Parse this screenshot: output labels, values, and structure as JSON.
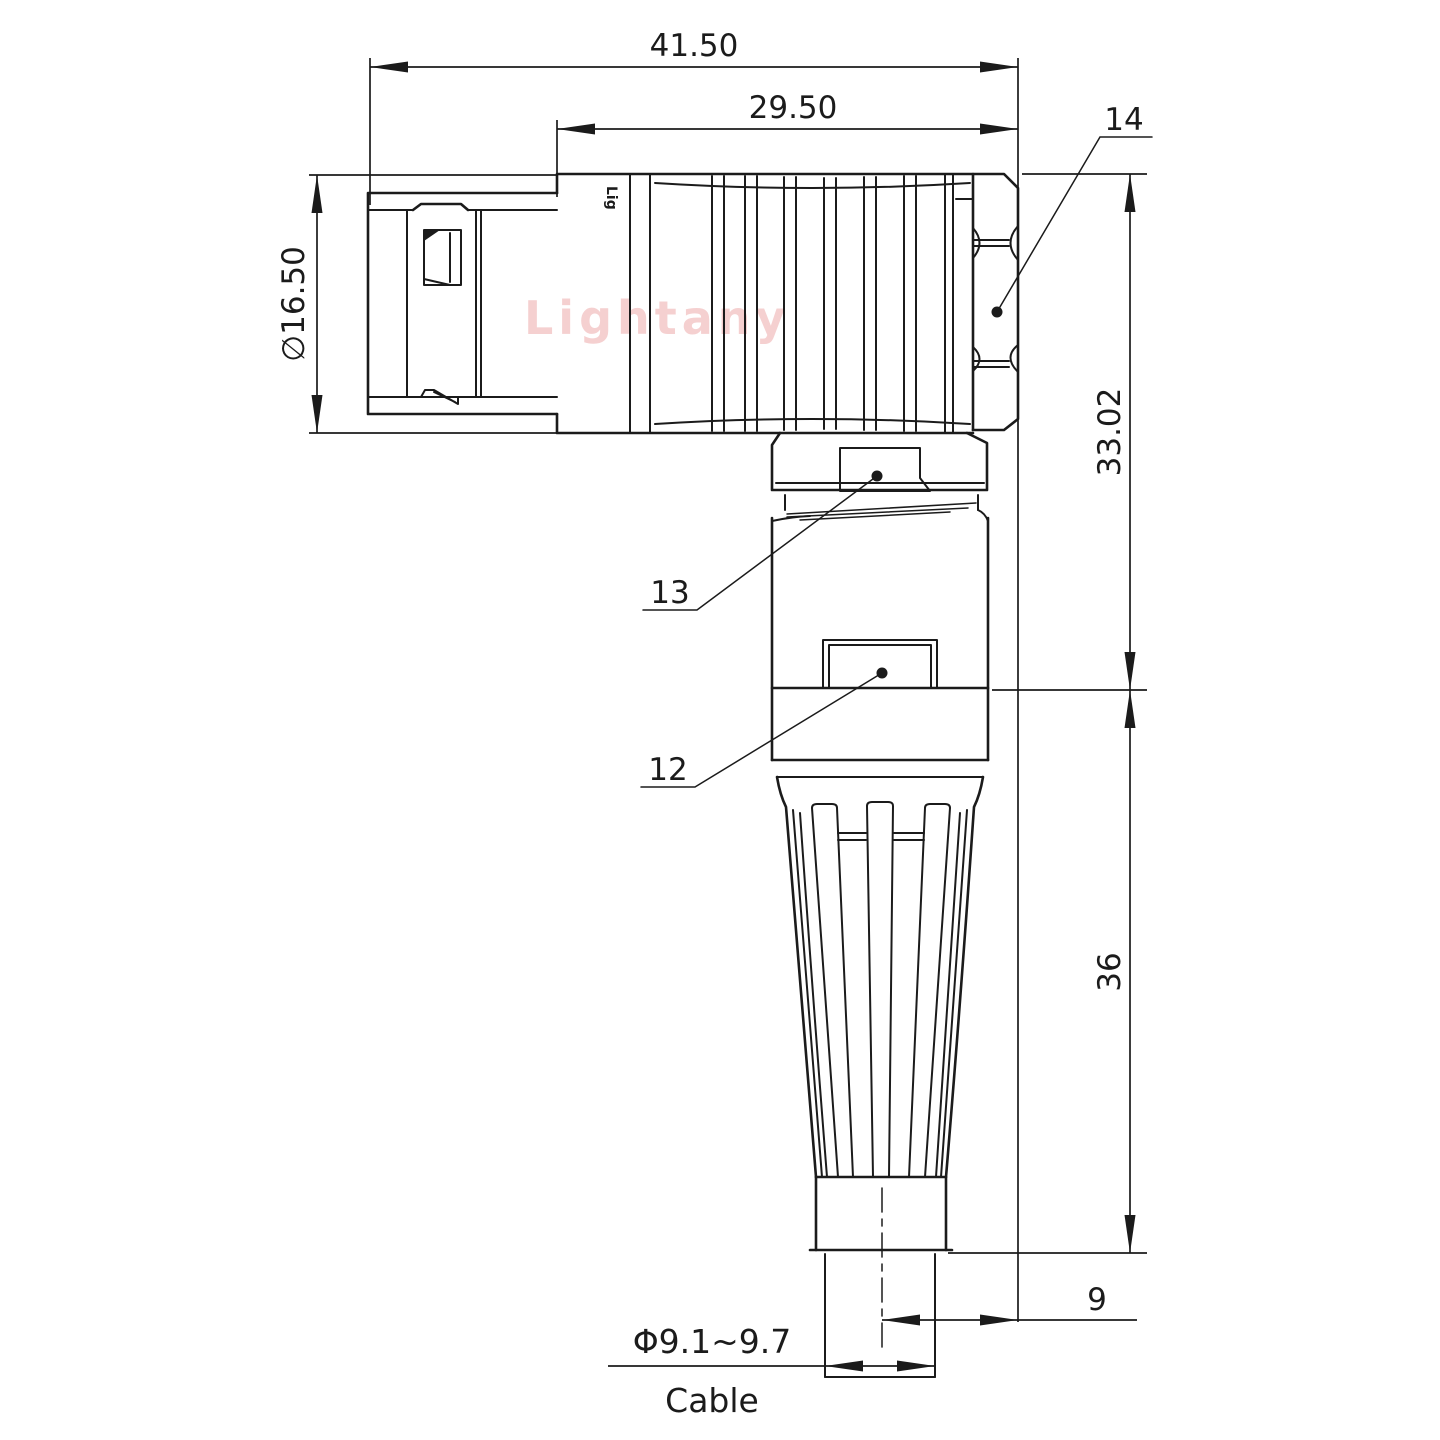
{
  "style": {
    "line_color": "#1b1b1b",
    "watermark_color": "#edaaaa",
    "background": "#ffffff"
  },
  "watermark": {
    "text": "Lightany"
  },
  "part": {
    "brand_mark": "Lig"
  },
  "dimensions": {
    "overall_length": "41.50",
    "front_length": "29.50",
    "shell_diameter": "∅16.50",
    "upper_height": "33.02",
    "lower_height": "36",
    "cable_offset": "9",
    "cable_diameter": "Φ9.1~9.7",
    "cable_label": "Cable"
  },
  "callouts": {
    "hex_nut": "14",
    "coupling_nut_flat": "13",
    "body_flat": "12"
  }
}
